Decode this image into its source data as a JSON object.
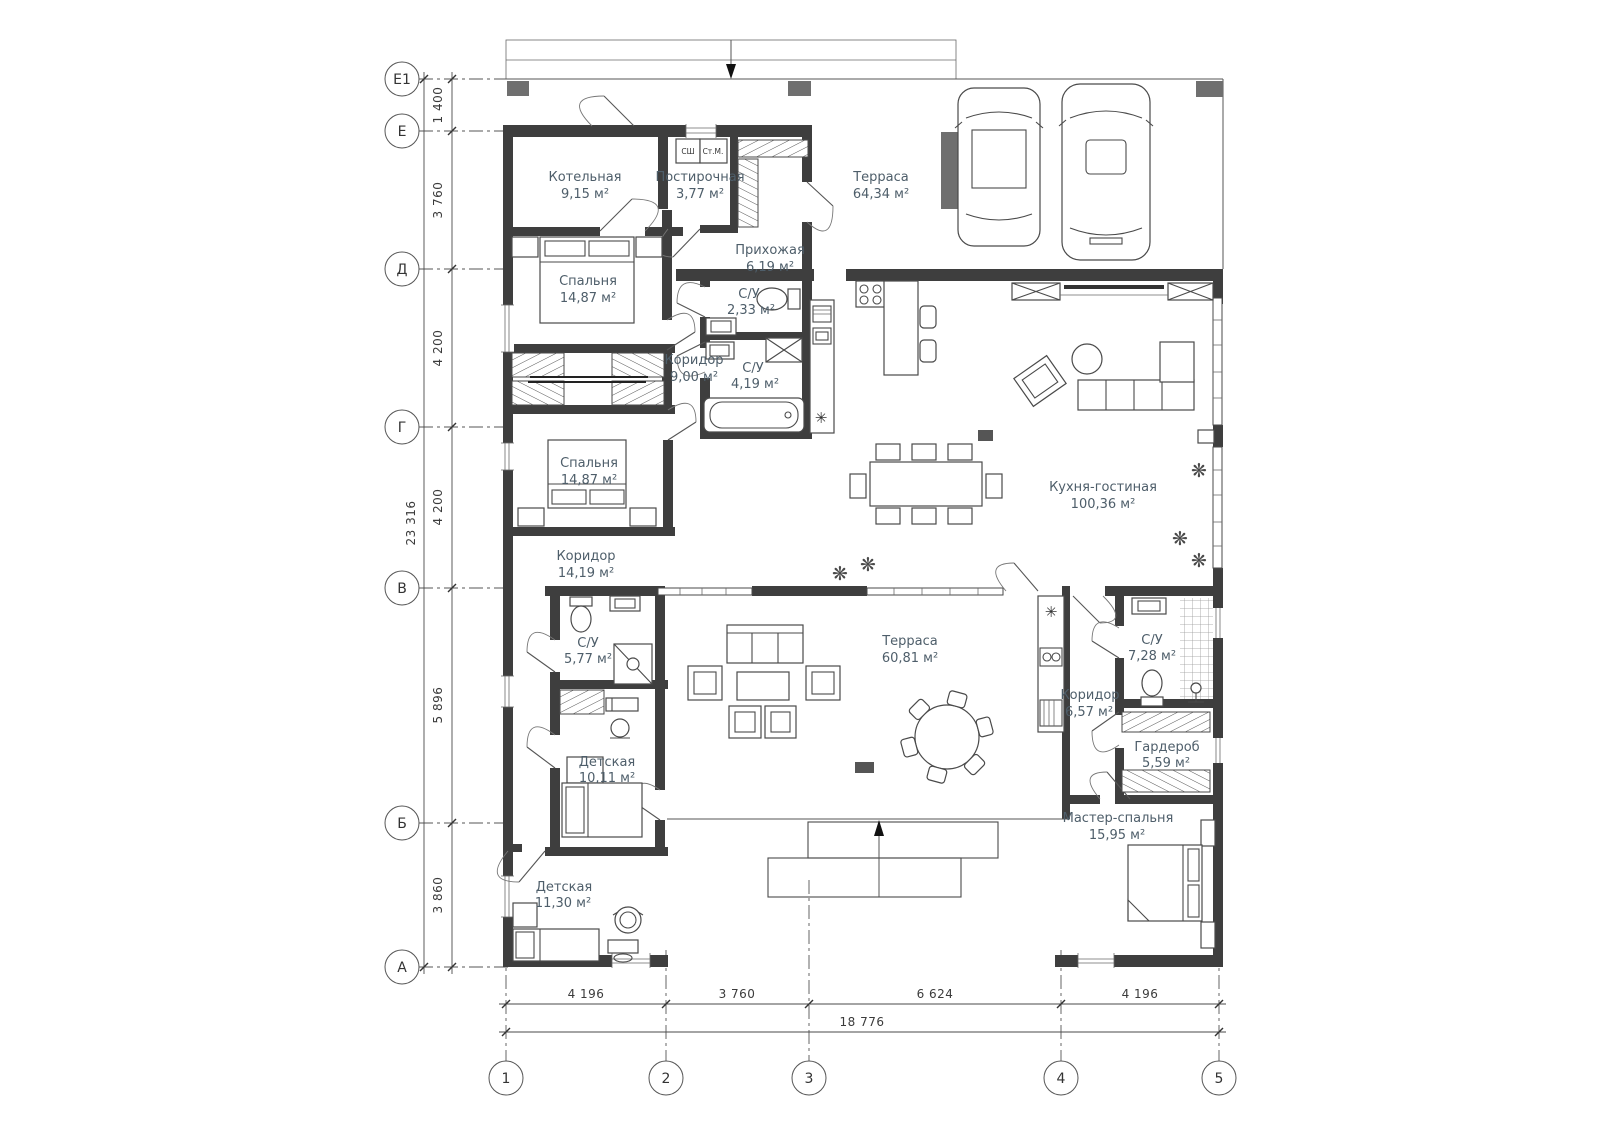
{
  "plan": {
    "rooms": [
      {
        "name": "Котельная",
        "area": "9,15 м²"
      },
      {
        "name": "Постирочная",
        "area": "3,77 м²"
      },
      {
        "name": "Терраса",
        "area": "64,34 м²"
      },
      {
        "name": "Спальня",
        "area": "14,87 м²"
      },
      {
        "name": "Прихожая",
        "area": "6,19 м²"
      },
      {
        "name": "С/У",
        "area": "2,33 м²"
      },
      {
        "name": "Коридор",
        "area": "9,00 м²"
      },
      {
        "name": "С/У",
        "area": "4,19 м²"
      },
      {
        "name": "Спальня",
        "area": "14,87 м²"
      },
      {
        "name": "Кухня-гостиная",
        "area": "100,36 м²"
      },
      {
        "name": "Коридор",
        "area": "14,19 м²"
      },
      {
        "name": "С/У",
        "area": "5,77 м²"
      },
      {
        "name": "Терраса",
        "area": "60,81 м²"
      },
      {
        "name": "С/У",
        "area": "7,28 м²"
      },
      {
        "name": "Коридор",
        "area": "6,57 м²"
      },
      {
        "name": "Гардероб",
        "area": "5,59 м²"
      },
      {
        "name": "Детская",
        "area": "10,11 м²"
      },
      {
        "name": "Мастер-спальня",
        "area": "15,95 м²"
      },
      {
        "name": "Детская",
        "area": "11,30 м²"
      }
    ],
    "axes_rows": [
      "Е1",
      "Е",
      "Д",
      "Г",
      "В",
      "Б",
      "А"
    ],
    "axes_cols": [
      "1",
      "2",
      "3",
      "4",
      "5"
    ],
    "dims_left": {
      "segments": [
        "1 400",
        "3 760",
        "4 200",
        "4 200",
        "5 896",
        "3 860"
      ],
      "total": "23 316"
    },
    "dims_bottom": {
      "segments": [
        "4 196",
        "3 760",
        "6 624",
        "4 196"
      ],
      "total": "18 776"
    },
    "appliances": {
      "dryer": "СШ",
      "washer": "Ст.М."
    },
    "symbols": {
      "fridge": "✳",
      "plant": "❋"
    }
  }
}
